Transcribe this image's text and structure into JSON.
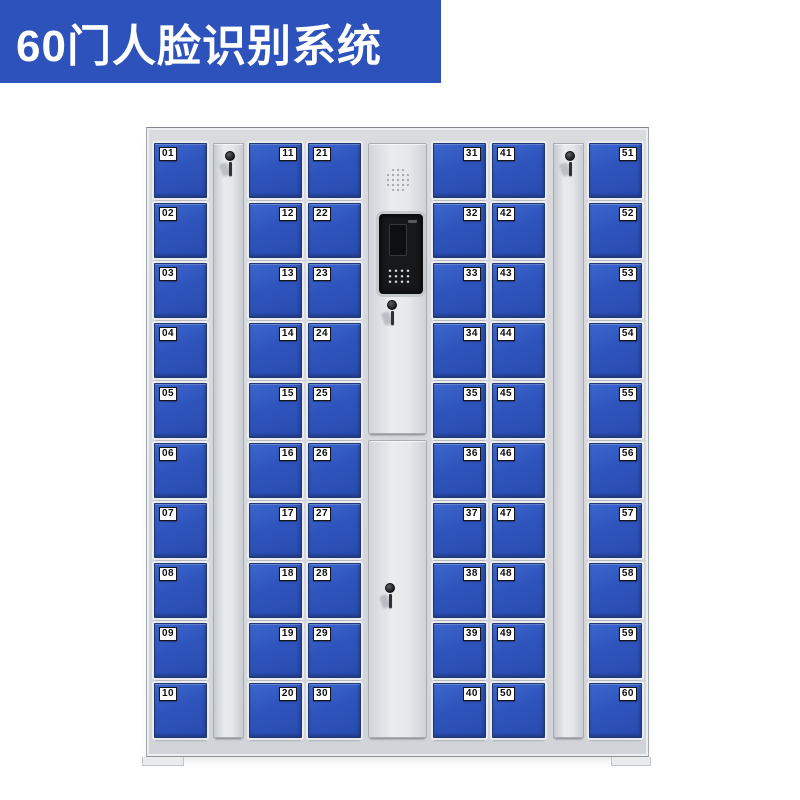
{
  "banner": {
    "title": "60门人脸识别系统"
  },
  "colors": {
    "banner_bg": "#2d52bb",
    "banner_text": "#ffffff",
    "door_blue": "#2e54bc",
    "door_border": "#20376f",
    "cabinet_frame": "#d6d8dc",
    "screen_black": "#17181b"
  },
  "cabinet": {
    "door_count": 60,
    "columns": [
      {
        "type": "doors",
        "label_side": "left",
        "numbers": [
          "01",
          "02",
          "03",
          "04",
          "05",
          "06",
          "07",
          "08",
          "09",
          "10"
        ]
      },
      {
        "type": "lock_strip",
        "icon": "key-lock-icon"
      },
      {
        "type": "doors",
        "label_side": "right",
        "numbers": [
          "11",
          "12",
          "13",
          "14",
          "15",
          "16",
          "17",
          "18",
          "19",
          "20"
        ]
      },
      {
        "type": "doors",
        "label_side": "left",
        "numbers": [
          "21",
          "22",
          "23",
          "24",
          "25",
          "26",
          "27",
          "28",
          "29",
          "30"
        ]
      },
      {
        "type": "control_panel",
        "features": [
          "speaker-grille",
          "face-recognition-camera-screen",
          "keypad",
          "key-lock-upper",
          "key-lock-lower"
        ]
      },
      {
        "type": "doors",
        "label_side": "right",
        "numbers": [
          "31",
          "32",
          "33",
          "34",
          "35",
          "36",
          "37",
          "38",
          "39",
          "40"
        ]
      },
      {
        "type": "doors",
        "label_side": "left",
        "numbers": [
          "41",
          "42",
          "43",
          "44",
          "45",
          "46",
          "47",
          "48",
          "49",
          "50"
        ]
      },
      {
        "type": "lock_strip",
        "icon": "key-lock-icon"
      },
      {
        "type": "doors",
        "label_side": "right",
        "numbers": [
          "51",
          "52",
          "53",
          "54",
          "55",
          "56",
          "57",
          "58",
          "59",
          "60"
        ]
      }
    ]
  }
}
